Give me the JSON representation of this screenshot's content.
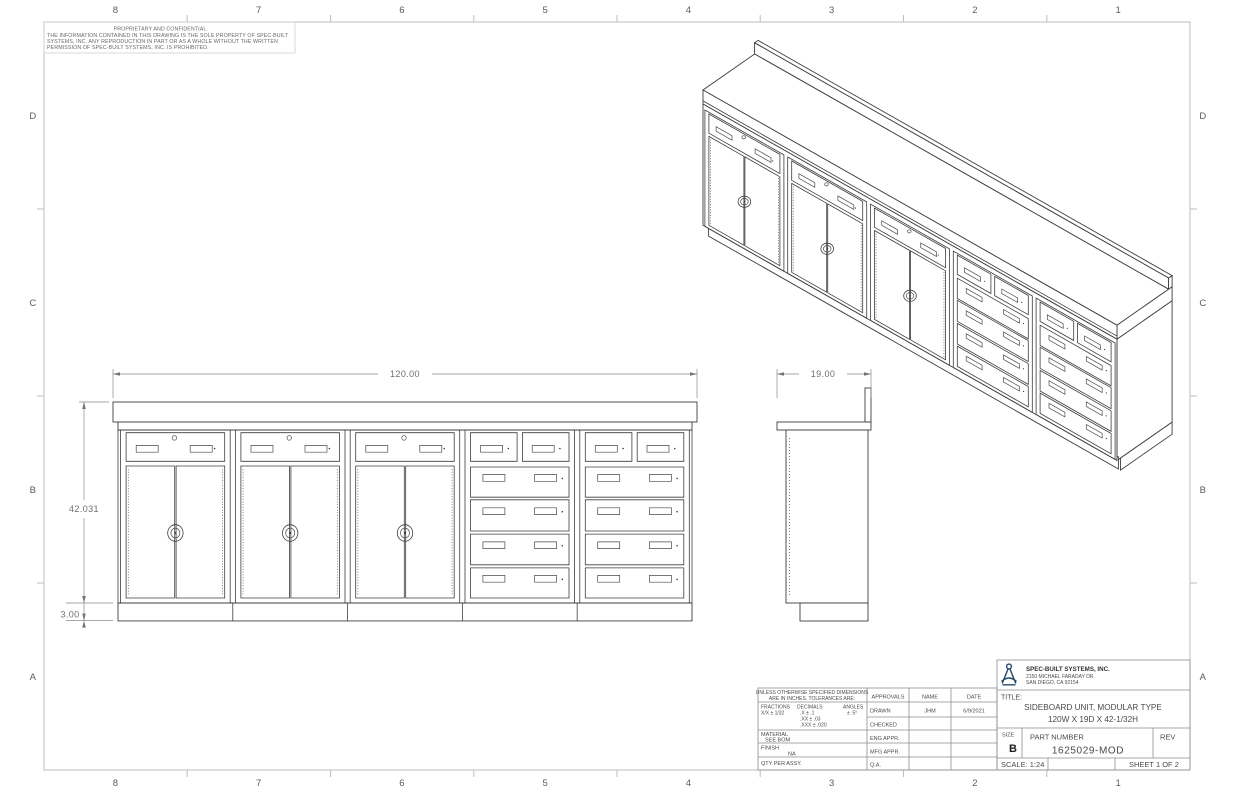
{
  "sheet": {
    "zones_top": [
      "8",
      "7",
      "6",
      "5",
      "4",
      "3",
      "2",
      "1"
    ],
    "zones_bottom": [
      "8",
      "7",
      "6",
      "5",
      "4",
      "3",
      "2",
      "1"
    ],
    "zones_left": [
      "D",
      "C",
      "B",
      "A"
    ],
    "zones_right": [
      "D",
      "C",
      "B",
      "A"
    ]
  },
  "proprietary": {
    "title": "PROPRIETARY AND CONFIDENTIAL",
    "line1": "THE INFORMATION CONTAINED IN THIS DRAWING IS THE SOLE PROPERTY OF SPEC-BUILT",
    "line2": "SYSTEMS, INC.  ANY REPRODUCTION IN PART OR AS A WHOLE WITHOUT THE WRITTEN",
    "line3": "PERMISSION OF SPEC-BUILT SYSTEMS, INC. IS PROHIBITED."
  },
  "dimensions": {
    "front_width": "120.00",
    "overall_height": "42.031",
    "base_height": "3.00",
    "side_depth": "19.00"
  },
  "tolerance_block": {
    "line1": "UNLESS OTHERWISE SPECIFIED DIMENSIONS",
    "line2": "ARE IN INCHES.  TOLERANCES ARE:",
    "fractions_label": "FRACTIONS",
    "fractions_value": "X/X ± 1/32",
    "decimals_label": "DECIMALS",
    "decimals_v1": ".X   ± .1",
    "decimals_v2": ".XX  ± .03",
    "decimals_v3": ".XXX ± .020",
    "angles_label": "ANGLES",
    "angles_value": "± .5°",
    "material_label": "MATERIAL",
    "material_value": "SEE BOM",
    "finish_label": "FINISH",
    "finish_value": "NA",
    "qty_label": "QTY PER ASSY."
  },
  "approvals": {
    "header": {
      "approvals": "APPROVALS",
      "name": "NAME",
      "date": "DATE"
    },
    "rows": [
      {
        "label": "DRAWN",
        "name": "JHM",
        "date": "6/9/2021"
      },
      {
        "label": "CHECKED",
        "name": "",
        "date": ""
      },
      {
        "label": "ENG APPR.",
        "name": "",
        "date": ""
      },
      {
        "label": "MFG APPR.",
        "name": "",
        "date": ""
      },
      {
        "label": "Q.A.",
        "name": "",
        "date": ""
      }
    ]
  },
  "title_block": {
    "company": "SPEC-BUILT SYSTEMS, INC.",
    "address1": "2150 MICHAEL FARADAY DR.",
    "address2": "SAN DIEGO, CA 92154",
    "title_label": "TITLE:",
    "title_line1": "SIDEBOARD UNIT, MODULAR TYPE",
    "title_line2": "120W X 19D X 42-1/32H",
    "size_label": "SIZE",
    "size_value": "B",
    "part_label": "PART NUMBER",
    "part_value": "1625029-MOD",
    "rev_label": "REV",
    "scale_text": "SCALE: 1:24",
    "sheet_text": "SHEET 1 OF 2"
  },
  "colors": {
    "drawing_line": "#3d3d3d",
    "dimension": "#6e6e6e",
    "frame": "#bdbdbd",
    "titleblock_line": "#8d8d8d",
    "text": "#4a4a4a",
    "logo_navy": "#24496b"
  }
}
